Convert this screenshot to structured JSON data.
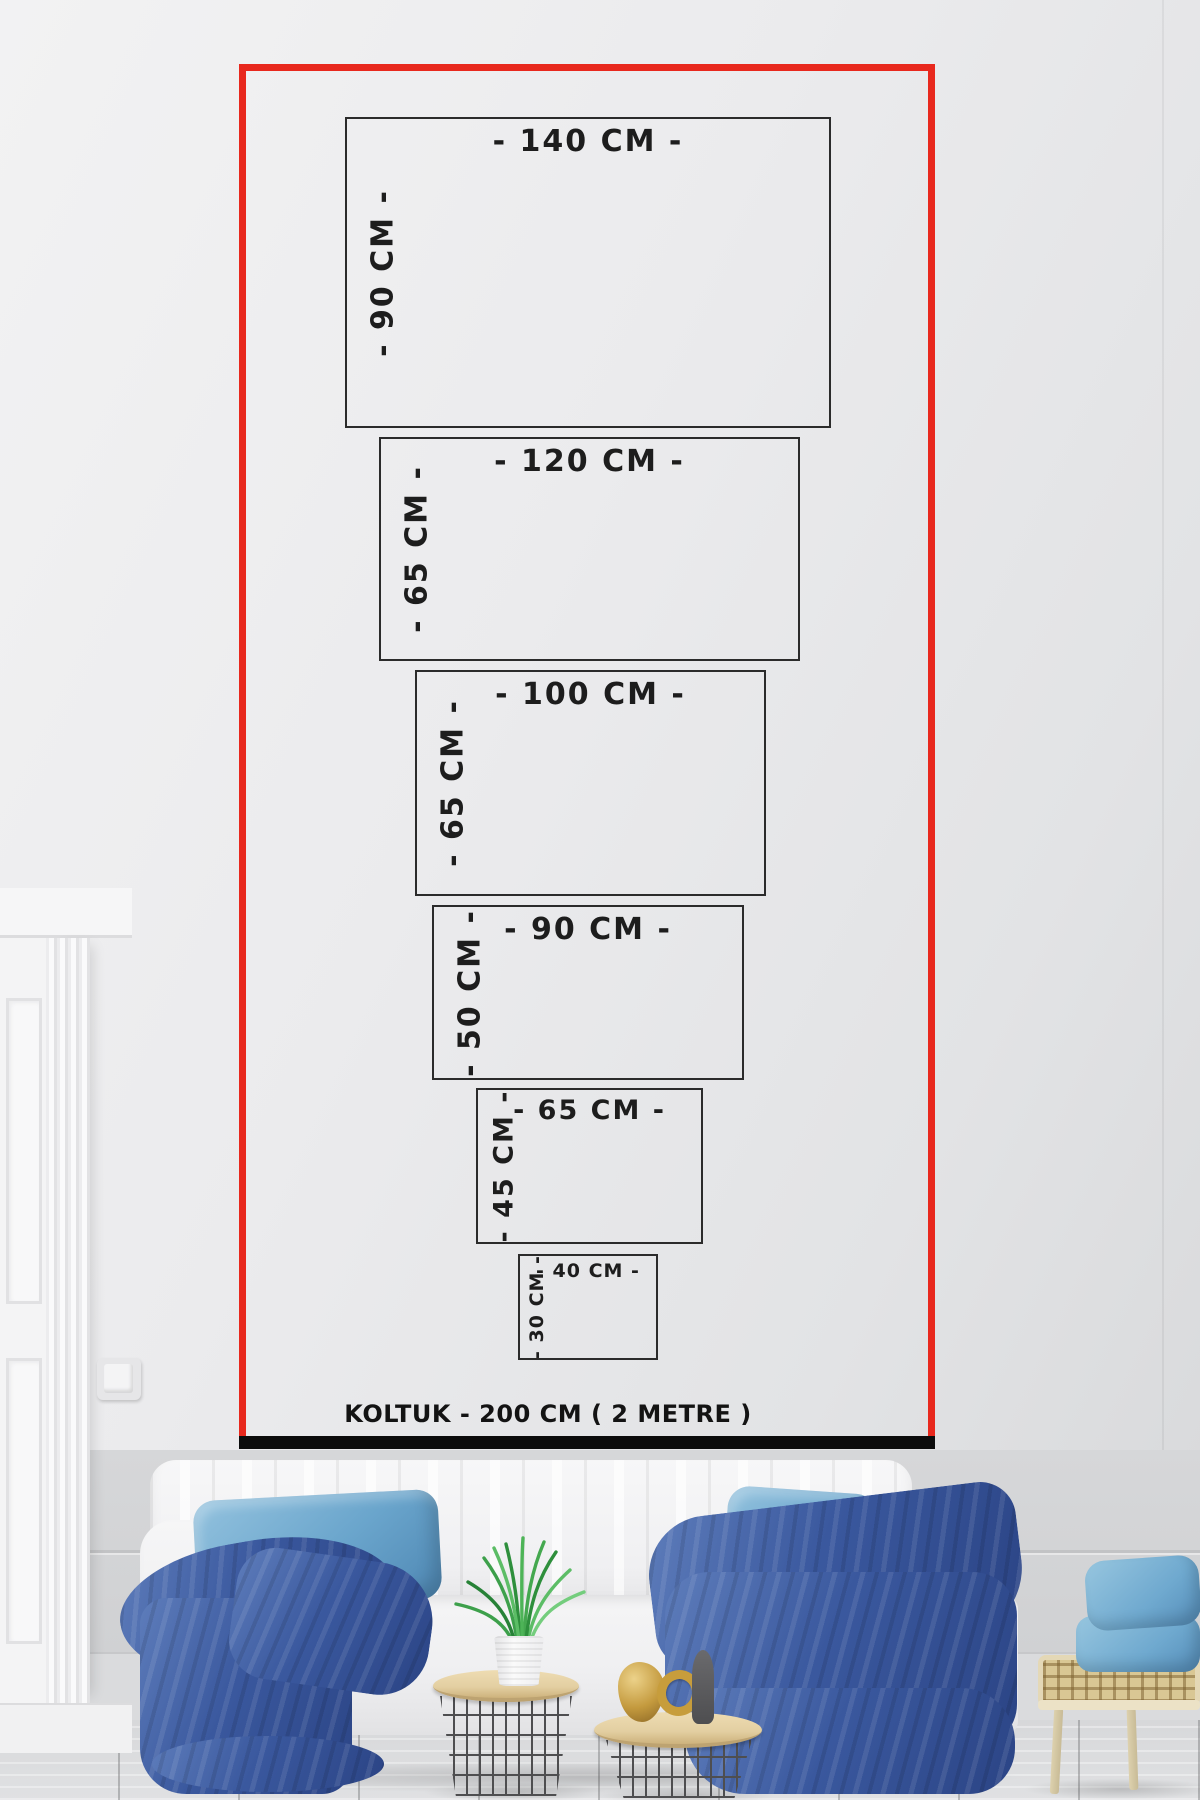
{
  "page": {
    "type": "canvas-print-size-guide"
  },
  "size_chart": {
    "frame_color": "#e8281d",
    "box_border_color": "#2b2b2b",
    "label_color": "#1d1d1d",
    "bar_color": "#0c0c0c",
    "sofa_label": "KOLTUK - 200 CM ( 2 METRE )",
    "sizes": [
      {
        "id": "140x90",
        "width_label": "- 140 CM -",
        "height_label": "- 90 CM -"
      },
      {
        "id": "120x65",
        "width_label": "- 120 CM -",
        "height_label": "- 65 CM -"
      },
      {
        "id": "100x65",
        "width_label": "- 100 CM -",
        "height_label": "- 65 CM -"
      },
      {
        "id": "90x50",
        "width_label": "- 90 CM -",
        "height_label": "- 50 CM -"
      },
      {
        "id": "65x45",
        "width_label": "- 65 CM -",
        "height_label": "- 45 CM -"
      },
      {
        "id": "40x30",
        "width_label": "- 40 CM -",
        "height_label": "- 30 CM -"
      }
    ]
  },
  "scene": {
    "colors": {
      "wall": "#d3d4d6",
      "floor": "#d9dadc",
      "sofa_white": "#f3f3f4",
      "throw_blue_dark": "#2f4c8e",
      "pillow_blue_light": "#6aa5cc",
      "table_wood": "#e6d2a6",
      "wire_frame": "#4e4e50",
      "rattan": "#d9c794",
      "plant_green": "#3da04b"
    },
    "objects": [
      "white-tufted-sofa",
      "light-blue-pillow-left",
      "light-blue-pillow-right",
      "navy-throw-left",
      "navy-throw-right",
      "wire-basket-table-with-plant",
      "wire-basket-table-with-decor",
      "gold-decor-objects",
      "grass-plant-in-white-pot",
      "rattan-bench",
      "stacked-light-blue-pillows",
      "white-door-molding",
      "light-switch",
      "wood-floor"
    ]
  }
}
